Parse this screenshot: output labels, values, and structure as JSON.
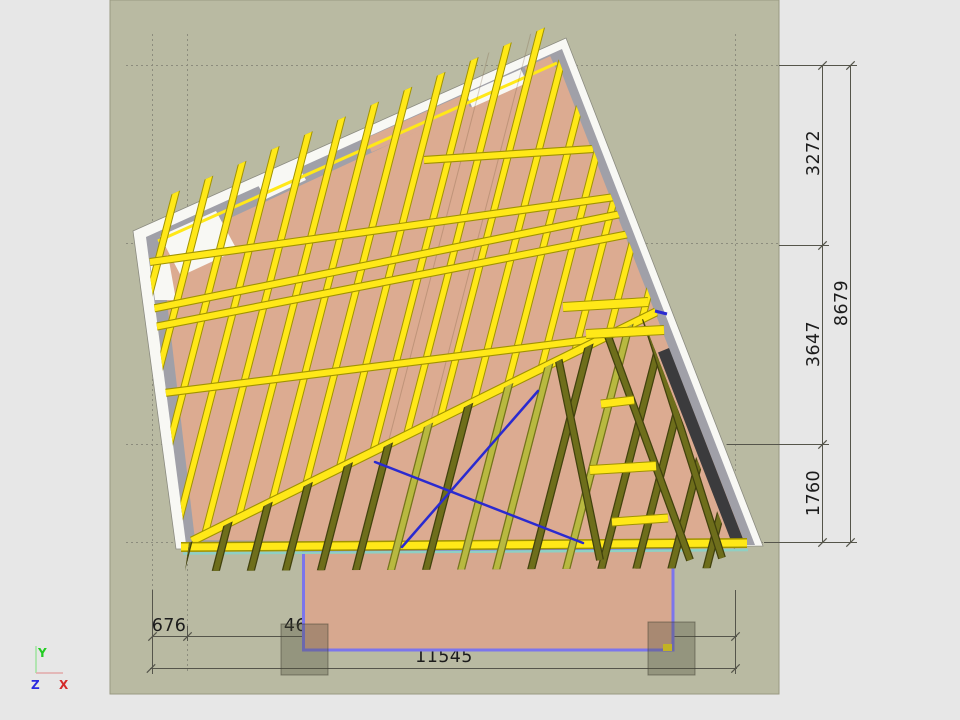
{
  "dimensions": {
    "right": {
      "seg1": "3272",
      "seg2": "3647",
      "seg3": "1760",
      "total": "8679"
    },
    "bottom": {
      "seg1": "676",
      "seg2": "46",
      "total": "11545"
    }
  },
  "axes": {
    "x": "X",
    "y": "Y",
    "z": "Z"
  },
  "colors": {
    "margin": "#e7e7e7",
    "canvas": "#b9baa2",
    "canvas_border": "#999a81",
    "guide": "#8c8c7d",
    "dim_line": "#55554b",
    "dim_text": "#1c1c1c",
    "wall_white": "#f8f8f4",
    "wall_gray": "#a0a0a8",
    "floor": "#dcab91",
    "ground": "#d7a88f",
    "ground_outline": "#7b75ec",
    "joist": "#ffe818",
    "joist_edge": "#a09300",
    "deck_dark": "#6e6e1b",
    "deck_dark_edge": "#41410d",
    "deck_light": "#b8b940",
    "deck_light_edge": "#73731a",
    "dark_strip": "#3b3b3d",
    "brace": "#2a2ad0",
    "teal": "#8ed0c4",
    "footing": "rgba(80,80,60,0.35)",
    "footing_edge": "rgba(60,60,45,0.5)",
    "axis_x": "#d42a2a",
    "axis_y": "#22cc22",
    "axis_z": "#2a2ae0",
    "axis_x_line": "#e2a9a9",
    "axis_y_line": "#9fe29f"
  }
}
